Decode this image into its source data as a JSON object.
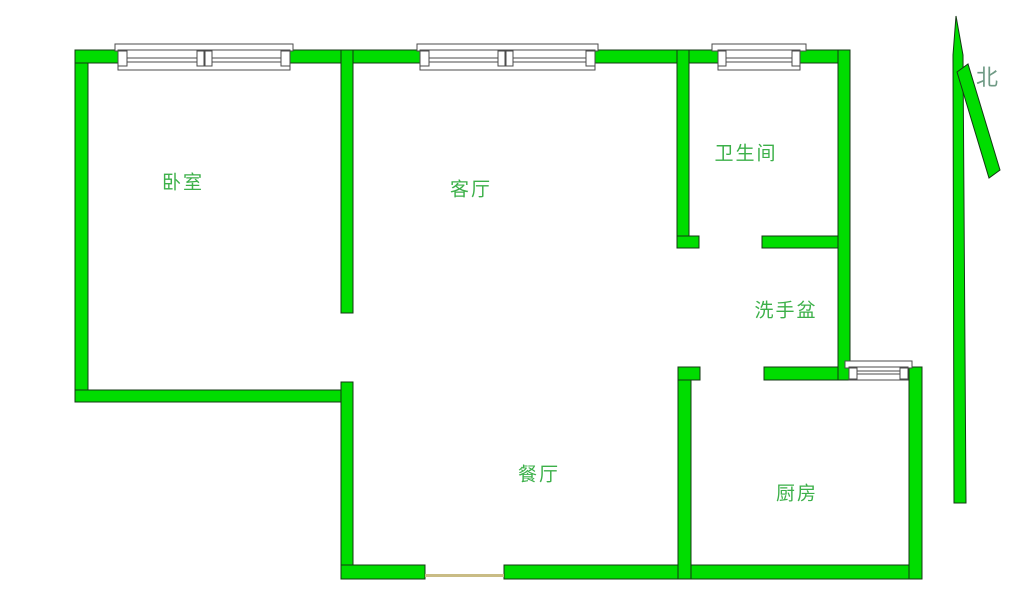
{
  "rooms": {
    "bedroom": {
      "label": "卧室"
    },
    "living_room": {
      "label": "客厅"
    },
    "bathroom": {
      "label": "卫生间"
    },
    "wash_basin": {
      "label": "洗手盆"
    },
    "dining_room": {
      "label": "餐厅"
    },
    "kitchen": {
      "label": "厨房"
    }
  },
  "compass": {
    "north_label": "北"
  },
  "features": {
    "windows": [
      "bedroom-window",
      "living-room-window",
      "bathroom-window",
      "kitchen-window"
    ],
    "door_openings": [
      "bedroom-door-opening",
      "bathroom-door-opening",
      "kitchen-door-opening",
      "dining-entry-opening"
    ]
  },
  "colors": {
    "background": "#ffffff",
    "wall_fill": "#00dd00",
    "wall_outline": "#143814",
    "room_label": "#3cb049",
    "compass_label": "#6f9a85",
    "door_threshold": "#c9bc85",
    "window_fill": "#ffffff",
    "window_outline": "#4b4b4b"
  }
}
